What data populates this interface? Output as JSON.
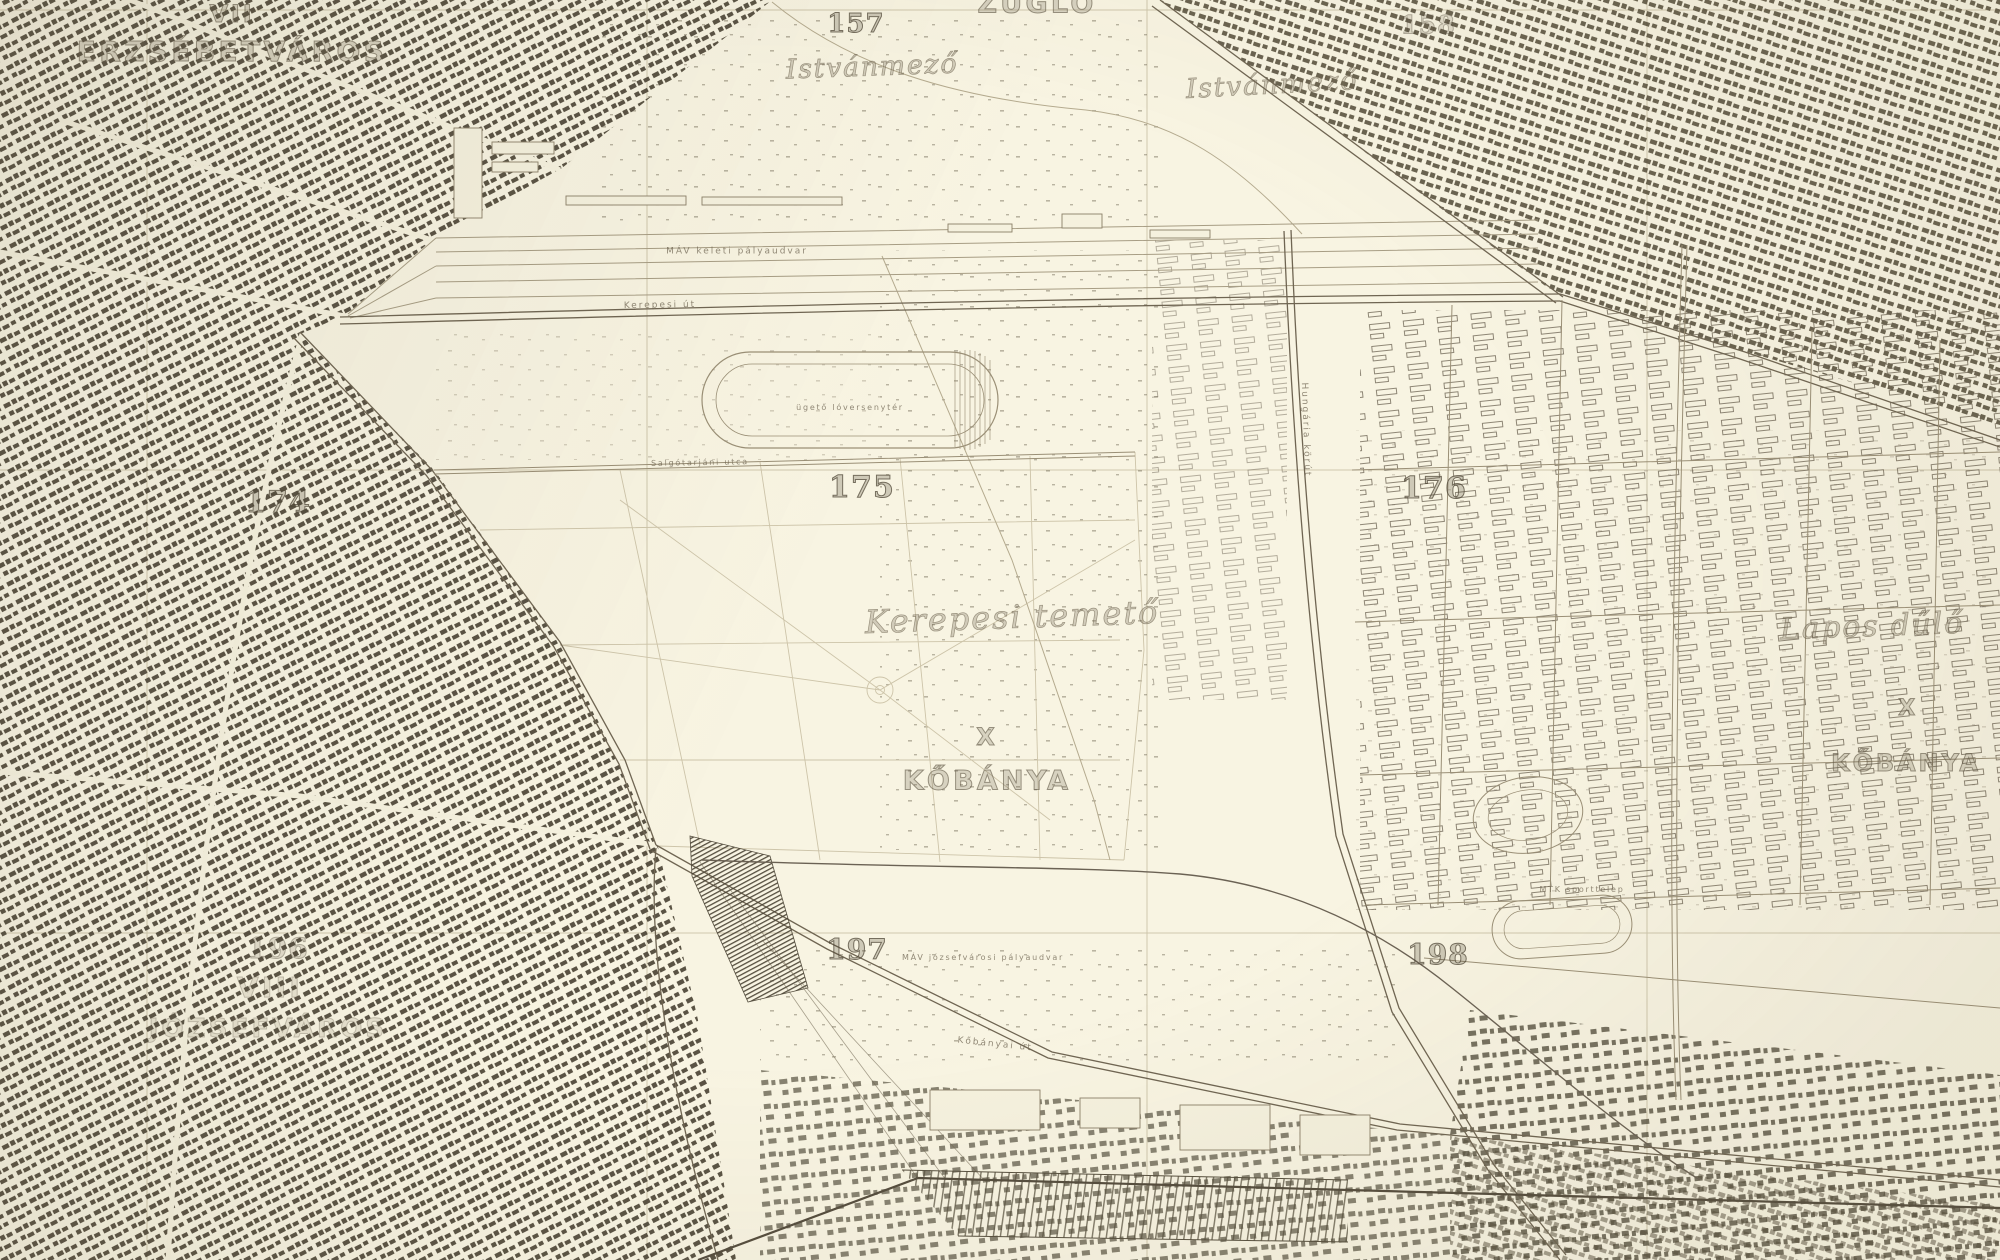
{
  "map": {
    "kind": "historical-topographic-city-map",
    "city_area": "Budapest – Kerepesi temető / Istvánmező / Kőbánya environs",
    "palette": {
      "paper": "#f8f4e2",
      "ink_dark": "#4c4536",
      "ink_mid": "#7a7060",
      "ink_faint": "#b4aa8e",
      "label_ink": "#6b6250"
    }
  },
  "labels": [
    {
      "text": "VII",
      "kind": "district"
    },
    {
      "text": "ERZSÉBETVÁROS",
      "kind": "district"
    },
    {
      "text": "157",
      "kind": "grid-number"
    },
    {
      "text": "Istvánmező",
      "kind": "place"
    },
    {
      "text": "ZUGLÓ",
      "kind": "district"
    },
    {
      "text": "Istvánmező",
      "kind": "place"
    },
    {
      "text": "158",
      "kind": "grid-number"
    },
    {
      "text": "174",
      "kind": "grid-number"
    },
    {
      "text": "175",
      "kind": "grid-number"
    },
    {
      "text": "176",
      "kind": "grid-number"
    },
    {
      "text": "Kerepesi temető",
      "kind": "place"
    },
    {
      "text": "X",
      "kind": "district"
    },
    {
      "text": "KŐBÁNYA",
      "kind": "district"
    },
    {
      "text": "Lapos dűlő",
      "kind": "place"
    },
    {
      "text": "X",
      "kind": "district"
    },
    {
      "text": "KŐBÁNYA",
      "kind": "district"
    },
    {
      "text": "196",
      "kind": "grid-number"
    },
    {
      "text": "VIII",
      "kind": "district"
    },
    {
      "text": "JÓZSEFVÁROS",
      "kind": "district"
    },
    {
      "text": "197",
      "kind": "grid-number"
    },
    {
      "text": "198",
      "kind": "grid-number"
    },
    {
      "text": "MÁV keleti pályaudvar",
      "kind": "minor"
    },
    {
      "text": "MÁV józsefvárosi pályaudvar",
      "kind": "minor"
    },
    {
      "text": "Kőbányai út",
      "kind": "street"
    },
    {
      "text": "ügető lóversenytér",
      "kind": "minor"
    },
    {
      "text": "MTK sporttelep",
      "kind": "minor"
    },
    {
      "text": "Kerepesi út",
      "kind": "street"
    },
    {
      "text": "Hungária körút",
      "kind": "street"
    },
    {
      "text": "Salgótarjáni utca",
      "kind": "street"
    }
  ]
}
